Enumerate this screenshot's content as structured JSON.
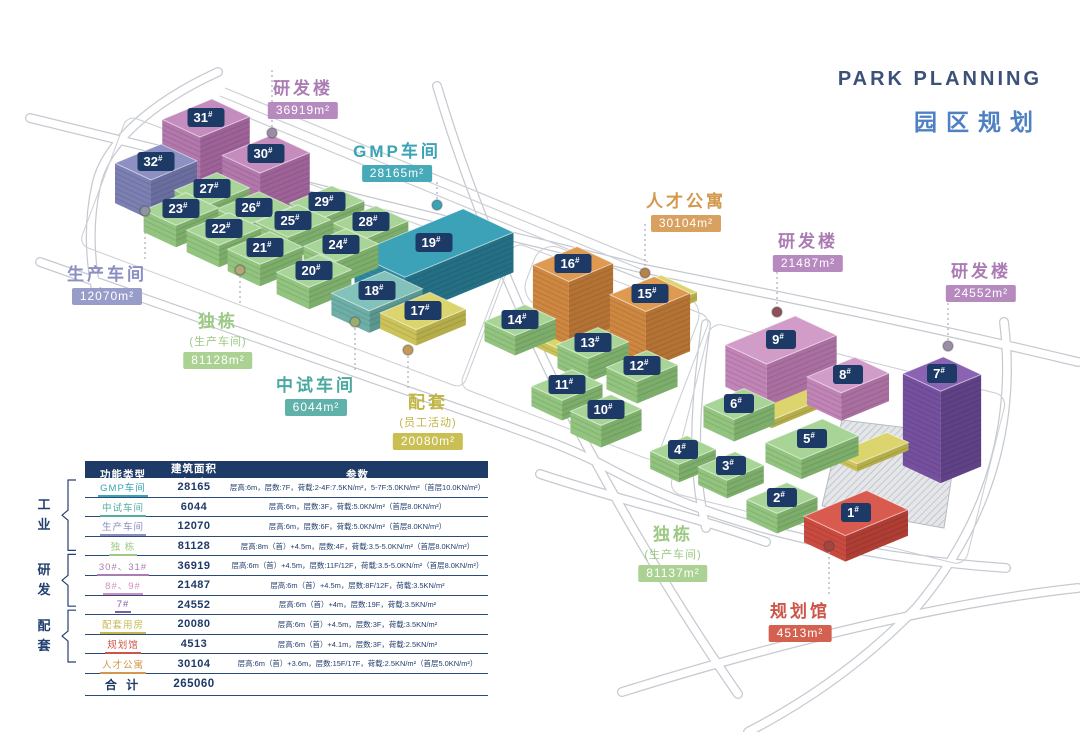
{
  "title": {
    "en": "PARK PLANNING",
    "zh": "园区规划"
  },
  "map": {
    "buildingColors": {
      "green": {
        "top": "#a8d597",
        "left": "#92c47f",
        "right": "#7cad6a"
      },
      "purple": {
        "top": "#c48dbd",
        "left": "#b277ab",
        "right": "#9d6297"
      },
      "slate": {
        "top": "#8c90c2",
        "left": "#7b7fb2",
        "right": "#6a6e9f"
      },
      "teal": {
        "top": "#3ba2b8",
        "left": "#2e89a0",
        "right": "#256f85"
      },
      "lightteal": {
        "top": "#82c2ba",
        "left": "#6dafa7",
        "right": "#5b968f"
      },
      "yellow": {
        "top": "#dcd46d",
        "left": "#cbc259",
        "right": "#b5ad4a"
      },
      "orange": {
        "top": "#df9a52",
        "left": "#ce8740",
        "right": "#b47335"
      },
      "pink": {
        "top": "#d29cc8",
        "left": "#c184b6",
        "right": "#a96fa0"
      },
      "darkpurple": {
        "top": "#8a63b2",
        "left": "#74509e",
        "right": "#5f4186"
      },
      "red": {
        "top": "#d95a4e",
        "left": "#c94a3f",
        "right": "#ae3d34"
      }
    },
    "badge": {
      "bg": "#1d3a66",
      "text": "#ffffff"
    },
    "buildings": [
      {
        "label": "31#",
        "x": 206,
        "y": 118,
        "w": 54,
        "d": 42,
        "h": 76,
        "color": "purple"
      },
      {
        "label": "30#",
        "x": 266,
        "y": 154,
        "w": 54,
        "d": 42,
        "h": 68,
        "color": "purple"
      },
      {
        "label": "32#",
        "x": 156,
        "y": 162,
        "w": 50,
        "d": 40,
        "h": 40,
        "color": "slate"
      },
      {
        "label": "27#",
        "x": 212,
        "y": 189,
        "w": 46,
        "d": 36,
        "h": 24,
        "color": "green"
      },
      {
        "label": "23#",
        "x": 181,
        "y": 209,
        "w": 46,
        "d": 36,
        "h": 22,
        "color": "green"
      },
      {
        "label": "26#",
        "x": 254,
        "y": 208,
        "w": 46,
        "d": 36,
        "h": 24,
        "color": "green"
      },
      {
        "label": "29#",
        "x": 327,
        "y": 202,
        "w": 46,
        "d": 36,
        "h": 24,
        "color": "green"
      },
      {
        "label": "22#",
        "x": 224,
        "y": 229,
        "w": 46,
        "d": 36,
        "h": 22,
        "color": "green"
      },
      {
        "label": "25#",
        "x": 293,
        "y": 221,
        "w": 46,
        "d": 36,
        "h": 24,
        "color": "green"
      },
      {
        "label": "28#",
        "x": 371,
        "y": 222,
        "w": 46,
        "d": 36,
        "h": 24,
        "color": "green"
      },
      {
        "label": "21#",
        "x": 265,
        "y": 248,
        "w": 46,
        "d": 36,
        "h": 22,
        "color": "green"
      },
      {
        "label": "24#",
        "x": 341,
        "y": 245,
        "w": 46,
        "d": 36,
        "h": 24,
        "color": "green"
      },
      {
        "label": "19#",
        "x": 434,
        "y": 243,
        "w": 118,
        "d": 56,
        "h": 40,
        "color": "teal"
      },
      {
        "label": "20#",
        "x": 314,
        "y": 271,
        "w": 46,
        "d": 36,
        "h": 22,
        "color": "green"
      },
      {
        "label": "18#",
        "x": 377,
        "y": 291,
        "w": 58,
        "d": 42,
        "h": 22,
        "color": "lightteal"
      },
      {
        "label": "17#",
        "x": 423,
        "y": 311,
        "w": 54,
        "d": 40,
        "h": 16,
        "color": "yellow"
      },
      {
        "label": "",
        "x": 610,
        "y": 312,
        "w": 150,
        "d": 40,
        "h": 9,
        "color": "yellow",
        "z": 255
      },
      {
        "label": "16#",
        "x": 573,
        "y": 264,
        "w": 48,
        "d": 40,
        "h": 64,
        "color": "orange"
      },
      {
        "label": "15#",
        "x": 650,
        "y": 294,
        "w": 48,
        "d": 40,
        "h": 58,
        "color": "orange"
      },
      {
        "label": "14#",
        "x": 520,
        "y": 320,
        "w": 44,
        "d": 34,
        "h": 20,
        "color": "green"
      },
      {
        "label": "13#",
        "x": 593,
        "y": 343,
        "w": 44,
        "d": 34,
        "h": 24,
        "color": "green"
      },
      {
        "label": "12#",
        "x": 642,
        "y": 366,
        "w": 44,
        "d": 34,
        "h": 22,
        "color": "green"
      },
      {
        "label": "11#",
        "x": 567,
        "y": 385,
        "w": 44,
        "d": 34,
        "h": 20,
        "color": "green"
      },
      {
        "label": "10#",
        "x": 606,
        "y": 410,
        "w": 44,
        "d": 34,
        "h": 22,
        "color": "green"
      },
      {
        "label": "",
        "x": 815,
        "y": 392,
        "w": 120,
        "d": 26,
        "h": 8,
        "color": "yellow",
        "z": 335
      },
      {
        "label": "",
        "x": 872,
        "y": 448,
        "w": 56,
        "d": 24,
        "h": 8,
        "color": "yellow",
        "z": 400
      },
      {
        "label": "9#",
        "x": 781,
        "y": 340,
        "w": 76,
        "d": 46,
        "h": 42,
        "color": "pink"
      },
      {
        "label": "8#",
        "x": 848,
        "y": 375,
        "w": 52,
        "d": 38,
        "h": 28,
        "color": "pink"
      },
      {
        "label": "7#",
        "x": 942,
        "y": 374,
        "w": 44,
        "d": 42,
        "h": 92,
        "color": "darkpurple"
      },
      {
        "label": "6#",
        "x": 739,
        "y": 404,
        "w": 44,
        "d": 34,
        "h": 22,
        "color": "green"
      },
      {
        "label": "5#",
        "x": 812,
        "y": 439,
        "w": 62,
        "d": 40,
        "h": 20,
        "color": "green"
      },
      {
        "label": "4#",
        "x": 683,
        "y": 450,
        "w": 40,
        "d": 32,
        "h": 18,
        "color": "green"
      },
      {
        "label": "3#",
        "x": 731,
        "y": 466,
        "w": 40,
        "d": 32,
        "h": 18,
        "color": "green"
      },
      {
        "label": "2#",
        "x": 782,
        "y": 498,
        "w": 44,
        "d": 34,
        "h": 20,
        "color": "green"
      },
      {
        "label": "1#",
        "x": 856,
        "y": 513,
        "w": 68,
        "d": 46,
        "h": 26,
        "color": "red"
      }
    ],
    "labels": [
      {
        "id": "rnd-west",
        "text": "研发楼",
        "area": "36919m²",
        "color": "#ab7cb3",
        "badge": "#b78abf",
        "x": 303,
        "y": 85
      },
      {
        "id": "gmp-workshop",
        "text": "GMP车间",
        "area": "28165m²",
        "color": "#3aa3b5",
        "badge": "#46aab9",
        "x": 397,
        "y": 148
      },
      {
        "id": "production-workshop",
        "text": "生产车间",
        "area": "12070m²",
        "color": "#8a8ec2",
        "badge": "#989cc9",
        "x": 107,
        "y": 271
      },
      {
        "id": "detached-west",
        "text": "独栋",
        "sub": "(生产车间)",
        "area": "81128m²",
        "color": "#9cc983",
        "badge": "#abd193",
        "x": 218,
        "y": 318
      },
      {
        "id": "pilot-workshop",
        "text": "中试车间",
        "area": "6044m²",
        "color": "#4aa8a0",
        "badge": "#5fb1a9",
        "x": 316,
        "y": 382
      },
      {
        "id": "amenity",
        "text": "配套",
        "sub": "(员工活动)",
        "area": "20080m²",
        "color": "#c0b545",
        "badge": "#c9bf53",
        "x": 428,
        "y": 399
      },
      {
        "id": "talent-apartments",
        "text": "人才公寓",
        "area": "30104m²",
        "color": "#d3984e",
        "badge": "#d8a15f",
        "x": 686,
        "y": 198
      },
      {
        "id": "rnd-mid",
        "text": "研发楼",
        "area": "21487m²",
        "color": "#ab7cb3",
        "badge": "#b78abf",
        "x": 808,
        "y": 238
      },
      {
        "id": "rnd-east",
        "text": "研发楼",
        "area": "24552m²",
        "color": "#ab7cb3",
        "badge": "#b78abf",
        "x": 981,
        "y": 268
      },
      {
        "id": "detached-east",
        "text": "独栋",
        "sub": "(生产车间)",
        "area": "81137m²",
        "color": "#9cc983",
        "badge": "#abd193",
        "x": 673,
        "y": 531
      },
      {
        "id": "planning-hall",
        "text": "规划馆",
        "area": "4513m²",
        "color": "#cc5448",
        "badge": "#d4604f",
        "x": 800,
        "y": 608
      }
    ],
    "leaders": [
      {
        "x": 272,
        "y1": 70,
        "y2": 127,
        "dot": [
          272,
          133
        ],
        "color": "#9b8da5"
      },
      {
        "x": 437,
        "y1": 182,
        "y2": 200,
        "dot": [
          437,
          205
        ],
        "color": "#3aa3b5"
      },
      {
        "x": 145,
        "y1": 217,
        "y2": 262,
        "dot": [
          145,
          211
        ],
        "color": "#8f959e"
      },
      {
        "x": 240,
        "y1": 276,
        "y2": 305,
        "dot": [
          240,
          270
        ],
        "color": "#b3a67c"
      },
      {
        "x": 355,
        "y1": 328,
        "y2": 372,
        "dot": [
          355,
          322
        ],
        "color": "#9aad6d"
      },
      {
        "x": 408,
        "y1": 356,
        "y2": 388,
        "dot": [
          408,
          350
        ],
        "color": "#c59a56"
      },
      {
        "x": 645,
        "y1": 224,
        "y2": 268,
        "dot": [
          645,
          273
        ],
        "color": "#b5824e"
      },
      {
        "x": 777,
        "y1": 262,
        "y2": 306,
        "dot": [
          777,
          312
        ],
        "color": "#8f5058"
      },
      {
        "x": 948,
        "y1": 298,
        "y2": 340,
        "dot": [
          948,
          346
        ],
        "color": "#9b8da5"
      },
      {
        "x": 829,
        "y1": 552,
        "y2": 596,
        "dot": [
          829,
          546
        ],
        "color": "#a5463c"
      }
    ]
  },
  "table": {
    "headers": [
      "功能类型",
      "建筑面积(m²)",
      "参数"
    ],
    "rows": [
      {
        "type": "GMP车间",
        "color": "#3aa3b5",
        "area": "28165",
        "params": "层高:6m，层数:7F，荷载:2-4F:7.5KN/m²，5-7F:5.0KN/m²（首层10.0KN/m²）"
      },
      {
        "type": "中试车间",
        "color": "#55aba3",
        "area": "6044",
        "params": "层高:6m，层数:3F，荷载:5.0KN/m²（首层8.0KN/m²）"
      },
      {
        "type": "生产车间",
        "color": "#8a8ec2",
        "area": "12070",
        "params": "层高:6m，层数:6F，荷载:5.0KN/m²（首层8.0KN/m²）"
      },
      {
        "type": "独 栋",
        "color": "#9cc983",
        "area": "81128",
        "params": "层高:8m（首）+4.5m，层数:4F，荷载:3.5-5.0KN/m²（首层8.0KN/m²）"
      },
      {
        "type": "30#、31#",
        "color": "#ab7cb3",
        "area": "36919",
        "params": "层高:6m（首）+4.5m，层数:11F/12F，荷载:3.5-5.0KN/m²（首层8.0KN/m²）"
      },
      {
        "type": "8#、9#",
        "color": "#cf8fc0",
        "area": "21487",
        "params": "层高:6m（首）+4.5m，层数:8F/12F，荷载:3.5KN/m²"
      },
      {
        "type": "7#",
        "color": "#7b5ea8",
        "area": "24552",
        "params": "层高:6m（首）+4m，层数:19F，荷载:3.5KN/m²"
      },
      {
        "type": "配套用房",
        "color": "#c4b84e",
        "area": "20080",
        "params": "层高:6m（首）+4.5m，层数:3F，荷载:3.5KN/m²"
      },
      {
        "type": "规划馆",
        "color": "#cc5448",
        "area": "4513",
        "params": "层高:6m（首）+4.1m，层数:3F，荷载:2.5KN/m²"
      },
      {
        "type": "人才公寓",
        "color": "#d3984e",
        "area": "30104",
        "params": "层高:6m（首）+3.6m，层数:15F/17F，荷载:2.5KN/m²（首层5.0KN/m²）"
      }
    ],
    "total_label": "合 计",
    "total_area": "265060"
  },
  "groups": [
    {
      "label": "工业",
      "row_start": 0,
      "row_end": 3
    },
    {
      "label": "研发",
      "row_start": 4,
      "row_end": 6
    },
    {
      "label": "配套",
      "row_start": 7,
      "row_end": 9
    }
  ]
}
